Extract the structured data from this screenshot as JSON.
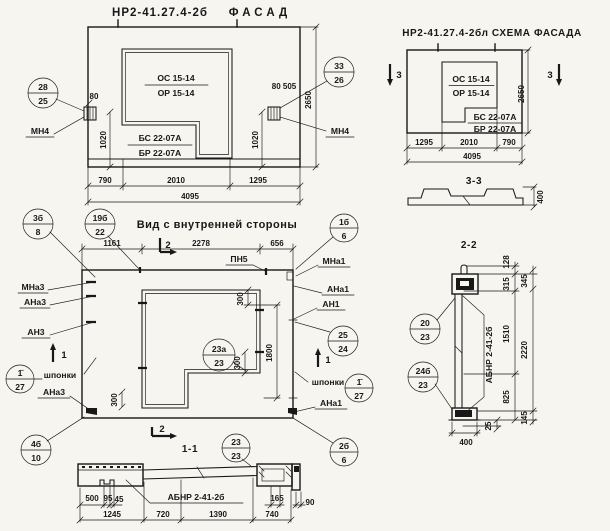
{
  "palette": {
    "paper": "#f6f5f0",
    "ink": "#181818"
  },
  "facade": {
    "title_code": "НР2-41.27.4-2б",
    "title_word": "ФАСАД",
    "os": "ОС 15-14",
    "orr": "ОР 15-14",
    "bs": "БС 22-07А",
    "br": "БР 22-07А",
    "mn4_left": "МН4",
    "mn4_right": "МН4",
    "c28": "28",
    "c25": "25",
    "c33": "33",
    "c26": "26",
    "d80": "80",
    "d80505": "80 505",
    "d1020l": "1020",
    "d1020r": "1020",
    "d2650": "2650",
    "d790": "790",
    "d2010": "2010",
    "d1295": "1295",
    "d4095": "4095"
  },
  "scheme": {
    "title": "НР2-41.27.4-2бл СХЕМА ФАСАДА",
    "os": "ОС 15-14",
    "orr": "ОР 15-14",
    "bs": "БС 22-07А",
    "br": "БР 22-07А",
    "m3l": "3",
    "m3r": "3",
    "d1295": "1295",
    "d2010": "2010",
    "d790": "790",
    "d4095": "4095",
    "d2650": "2650"
  },
  "s33": {
    "title": "3-3",
    "d400": "400"
  },
  "inner": {
    "title": "Вид с внутренней стороны",
    "c3b": "3б",
    "c8": "8",
    "c19b": "19б",
    "c22": "22",
    "d1161": "1161",
    "d2278": "2278",
    "d656": "656",
    "m2t": "2",
    "pn5": "ПН5",
    "mna3": "МНа3",
    "ana3a": "АНа3",
    "an3": "АН3",
    "m1l": "1",
    "shp_l": "шпонки",
    "c1l": "1̄",
    "c27l": "27",
    "ana3b": "АНа3",
    "c4b": "4б",
    "c10": "10",
    "c1b": "1б",
    "c6t": "6",
    "mna1": "МНа1",
    "ana1a": "АНа1",
    "an1": "АН1",
    "c25": "25",
    "c24": "24",
    "m1r": "1",
    "shp_r": "шпонки",
    "c1r": "1̄",
    "c27r": "27",
    "ana1b": "АНа1",
    "c2b": "2б",
    "c6r": "6",
    "c23a": "23а",
    "c23a2": "23",
    "d300a": "300",
    "d300b": "300",
    "d300c": "300",
    "d1800": "1800",
    "m2b": "2"
  },
  "s11": {
    "title": "1-1",
    "label": "АБНР 2-41-2б",
    "c23t": "23",
    "c23b": "23",
    "d500": "500",
    "d95": "95",
    "d45": "45",
    "d165": "165",
    "d90": "90",
    "d1245": "1245",
    "d720": "720",
    "d1390": "1390",
    "d740": "740"
  },
  "s22": {
    "title": "2-2",
    "label": "АБНР 2-41-2б",
    "c20": "20",
    "c23a": "23",
    "c24b": "24б",
    "c23b": "23",
    "d128": "128",
    "d315": "315",
    "d345": "345",
    "d1510": "1510",
    "d2220": "2220",
    "d825": "825",
    "d25": "25",
    "d145": "145",
    "d400": "400"
  }
}
